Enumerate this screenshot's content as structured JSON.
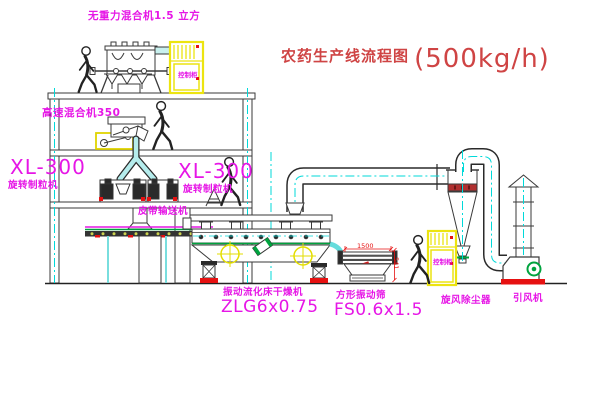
{
  "title": {
    "text": "农药生产线流程图",
    "capacity": "(500kg/h)"
  },
  "equipment_labels": {
    "gravity_mixer": "无重力混合机1.5 立方",
    "high_speed_mixer": "高速混合机350",
    "granulator_left": {
      "model": "XL-300",
      "name": "旋转制粒机"
    },
    "granulator_right": {
      "model": "XL-300",
      "name": "旋转制粒机"
    },
    "belt_conveyor": "皮带输送机",
    "fluid_bed_dryer": {
      "name": "振动流化床干燥机",
      "model": "ZLG6x0.75"
    },
    "vibrating_screen": {
      "name": "方形振动筛",
      "model": "FS0.6x1.5"
    },
    "cyclone": "旋风除尘器",
    "induced_draft_fan": "引风机",
    "control_cabinet_upper": "控制柜",
    "control_cabinet_lower": "控制柜"
  },
  "dimensions": {
    "screen_length": "1500",
    "screen_height": "541"
  },
  "colors": {
    "label_magenta": "#e616e6",
    "title_red": "#cf4444",
    "centerline_cyan": "#00d9d9",
    "highlight_yellow": "#ece410",
    "alert_red": "#e61111",
    "machine_green": "#00a33e",
    "line_dark": "#3a3a3a"
  }
}
